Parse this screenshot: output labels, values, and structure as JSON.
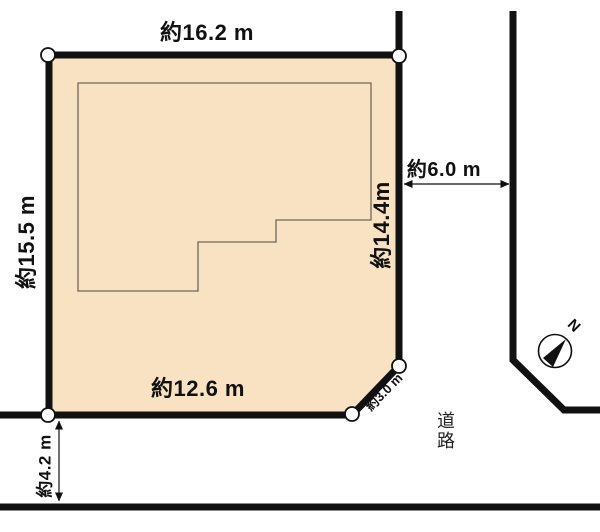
{
  "diagram": {
    "labels": {
      "top_edge": "約16.2 m",
      "left_edge": "約15.5 m",
      "right_edge": "約14.4m",
      "bottom_edge": "約12.6 m",
      "corner_cut": "約3.0 m",
      "road_width_east": "約6.0 m",
      "road_width_south": "約4.2 m",
      "road": "道路",
      "compass_north": "N"
    },
    "colors": {
      "lot_fill": "#F9E2C1",
      "line": "#111111",
      "building_outline": "#6F675B",
      "marker_fill": "#FFFFFF",
      "background": "#FFFFFF"
    }
  }
}
